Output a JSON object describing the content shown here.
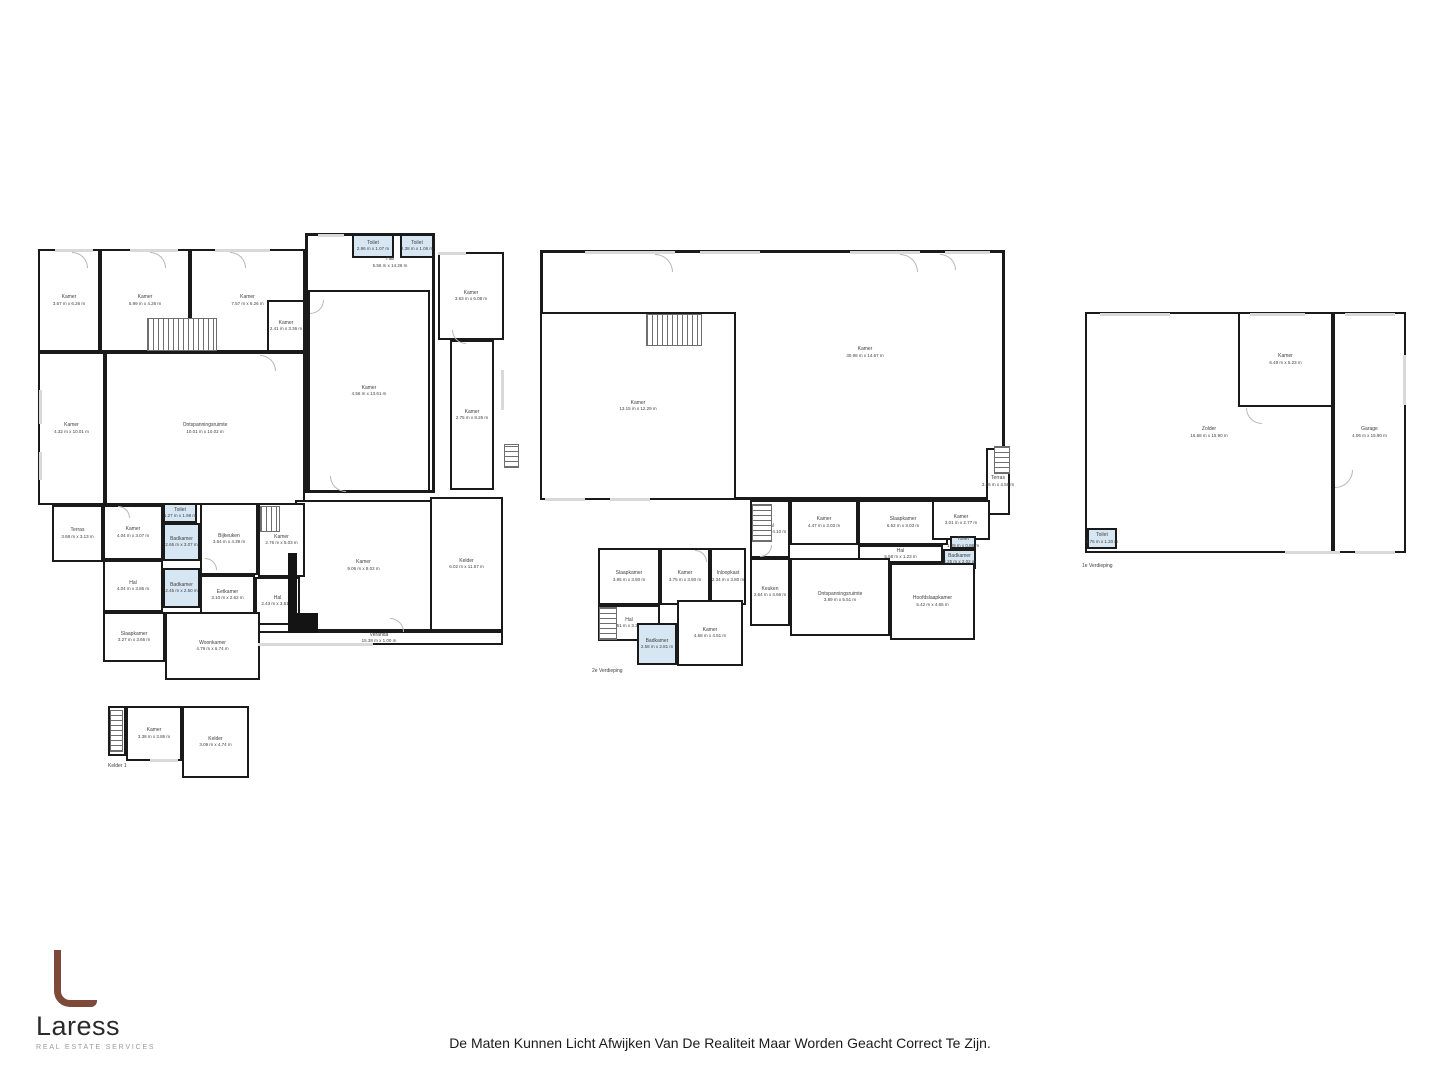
{
  "page": {
    "background": "#ffffff",
    "disclaimer": "De Maten Kunnen Licht Afwijken Van De Realiteit Maar Worden Geacht Correct Te Zijn."
  },
  "logo": {
    "name": "Laress",
    "subtitle": "REAL ESTATE SERVICES",
    "accent": "#7d4938"
  },
  "colors": {
    "wall": "#1a1a1a",
    "wet": "#d7e6f3",
    "window": "#d9d9d9",
    "label": "#3f3f3f",
    "door": "#b8b8b8",
    "shaft": "#141414"
  },
  "plans": [
    {
      "id": "begane-grond",
      "floor_label": null,
      "outlines": [
        {
          "x": 305,
          "y": 233,
          "w": 130,
          "h": 260
        }
      ],
      "texts": [
        {
          "name": "Hal",
          "dims": "5.56 m x 14.26 m",
          "x": 345,
          "y": 256,
          "w": 90
        }
      ],
      "rooms": [
        {
          "name": "Kamer",
          "dims": "3.67 m x 6.26 m",
          "x": 38,
          "y": 249,
          "w": 62,
          "h": 103
        },
        {
          "name": "Kamer",
          "dims": "5.99 m x 4.26 m",
          "x": 100,
          "y": 249,
          "w": 90,
          "h": 103
        },
        {
          "name": "Kamer",
          "dims": "7.57 m x 6.26 m",
          "x": 190,
          "y": 249,
          "w": 115,
          "h": 103
        },
        {
          "name": "Kamer",
          "dims": "2.41 m x 3.36 m",
          "x": 267,
          "y": 300,
          "w": 38,
          "h": 52
        },
        {
          "name": "Kamer",
          "dims": "4.32 m x 10.01 m",
          "x": 38,
          "y": 352,
          "w": 67,
          "h": 153
        },
        {
          "name": "Ontspanningsruimte",
          "dims": "10.01 m x 10.02 m",
          "x": 105,
          "y": 352,
          "w": 200,
          "h": 153
        },
        {
          "name": "Toilet",
          "dims": "2.96 m x 1.07 m",
          "x": 352,
          "y": 234,
          "w": 42,
          "h": 24,
          "wet": true
        },
        {
          "name": "Toilet",
          "dims": "2.38 m x 1.06 m",
          "x": 400,
          "y": 234,
          "w": 34,
          "h": 24,
          "wet": true
        },
        {
          "name": "Kamer",
          "dims": "4.56 m x 13.61 m",
          "x": 308,
          "y": 290,
          "w": 122,
          "h": 202
        },
        {
          "name": "Kamer",
          "dims": "3.63 m x 6.08 m",
          "x": 438,
          "y": 252,
          "w": 66,
          "h": 88
        },
        {
          "name": "Kamer",
          "dims": "2.75 m x 8.26 m",
          "x": 450,
          "y": 340,
          "w": 44,
          "h": 150
        },
        {
          "name": "Kelder",
          "dims": "6.02 m x 11.57 m",
          "x": 430,
          "y": 497,
          "w": 73,
          "h": 134
        },
        {
          "name": "Kamer",
          "dims": "9.06 m x 8.02 m",
          "x": 295,
          "y": 500,
          "w": 137,
          "h": 131
        },
        {
          "name": "Veranda",
          "dims": "15.38 m x 1.00 m",
          "x": 255,
          "y": 631,
          "w": 248,
          "h": 14
        },
        {
          "name": "Terras",
          "dims": "3.68 m x 3.13 m",
          "x": 52,
          "y": 505,
          "w": 51,
          "h": 57
        },
        {
          "name": "Kamer",
          "dims": "4.04 m x 3.07 m",
          "x": 103,
          "y": 505,
          "w": 60,
          "h": 55
        },
        {
          "name": "Toilet",
          "dims": "1.27 m x 1.98 m",
          "x": 163,
          "y": 503,
          "w": 34,
          "h": 20,
          "wet": true
        },
        {
          "name": "Badkamer",
          "dims": "2.65 m x 3.07 m",
          "x": 163,
          "y": 523,
          "w": 37,
          "h": 38,
          "wet": true
        },
        {
          "name": "Bijkeuken",
          "dims": "3.54 m x 4.39 m",
          "x": 200,
          "y": 503,
          "w": 58,
          "h": 72
        },
        {
          "name": "Kamer",
          "dims": "2.76 m x 5.03 m",
          "x": 258,
          "y": 503,
          "w": 47,
          "h": 74
        },
        {
          "name": "Hal",
          "dims": "4.04 m x 3.85 m",
          "x": 103,
          "y": 560,
          "w": 60,
          "h": 52
        },
        {
          "name": "Badkamer",
          "dims": "2.45 m x 2.50 m",
          "x": 163,
          "y": 568,
          "w": 37,
          "h": 40,
          "wet": true
        },
        {
          "name": "Eetkamer",
          "dims": "3.10 m x 2.62 m",
          "x": 200,
          "y": 575,
          "w": 55,
          "h": 40
        },
        {
          "name": "Hal",
          "dims": "2.43 m x 3.51 m",
          "x": 255,
          "y": 577,
          "w": 45,
          "h": 48
        },
        {
          "name": "Slaapkamer",
          "dims": "3.27 m x 3.66 m",
          "x": 103,
          "y": 612,
          "w": 62,
          "h": 50
        },
        {
          "name": "Woonkamer",
          "dims": "4.79 m x 6.74 m",
          "x": 165,
          "y": 612,
          "w": 95,
          "h": 68
        }
      ],
      "features": [
        {
          "type": "stairs",
          "x": 147,
          "y": 318,
          "w": 70,
          "h": 33,
          "angle": 90
        },
        {
          "type": "stairs",
          "x": 504,
          "y": 444,
          "w": 15,
          "h": 24,
          "angle": 0
        },
        {
          "type": "stairs",
          "x": 260,
          "y": 506,
          "w": 20,
          "h": 26,
          "angle": 90
        },
        {
          "type": "shaft",
          "x": 288,
          "y": 553,
          "w": 9,
          "h": 80
        },
        {
          "type": "shaft",
          "x": 288,
          "y": 613,
          "w": 30,
          "h": 20
        },
        {
          "type": "window",
          "x": 55,
          "y": 249,
          "w": 38,
          "h": 3
        },
        {
          "type": "window",
          "x": 130,
          "y": 249,
          "w": 48,
          "h": 3
        },
        {
          "type": "window",
          "x": 215,
          "y": 249,
          "w": 55,
          "h": 3
        },
        {
          "type": "window",
          "x": 318,
          "y": 234,
          "w": 26,
          "h": 3
        },
        {
          "type": "window",
          "x": 39,
          "y": 390,
          "w": 3,
          "h": 34
        },
        {
          "type": "window",
          "x": 39,
          "y": 452,
          "w": 3,
          "h": 28
        },
        {
          "type": "window",
          "x": 258,
          "y": 643,
          "w": 115,
          "h": 3
        },
        {
          "type": "window",
          "x": 438,
          "y": 252,
          "w": 28,
          "h": 3
        },
        {
          "type": "window",
          "x": 501,
          "y": 370,
          "w": 3,
          "h": 40
        },
        {
          "type": "door",
          "x": 72,
          "y": 252,
          "s": 16,
          "rot": 0
        },
        {
          "type": "door",
          "x": 150,
          "y": 252,
          "s": 16,
          "rot": 0
        },
        {
          "type": "door",
          "x": 230,
          "y": 252,
          "s": 16,
          "rot": 0
        },
        {
          "type": "door",
          "x": 310,
          "y": 300,
          "s": 14,
          "rot": 90
        },
        {
          "type": "door",
          "x": 330,
          "y": 476,
          "s": 16,
          "rot": 180
        },
        {
          "type": "door",
          "x": 452,
          "y": 330,
          "s": 14,
          "rot": 180
        },
        {
          "type": "door",
          "x": 205,
          "y": 558,
          "s": 12,
          "rot": 0
        },
        {
          "type": "door",
          "x": 118,
          "y": 506,
          "s": 12,
          "rot": 0
        },
        {
          "type": "door",
          "x": 390,
          "y": 618,
          "s": 14,
          "rot": 0
        },
        {
          "type": "door",
          "x": 260,
          "y": 355,
          "s": 16,
          "rot": 0
        }
      ]
    },
    {
      "id": "kelder-1",
      "floor_label": {
        "text": "Kelder 1",
        "x": 108,
        "y": 763
      },
      "outlines": [],
      "texts": [],
      "rooms": [
        {
          "name": "Hal",
          "dims": "2.03 m x 1.04 m",
          "x": 108,
          "y": 706,
          "w": 18,
          "h": 50,
          "vertical": true
        },
        {
          "name": "Kamer",
          "dims": "3.38 m x 3.86 m",
          "x": 126,
          "y": 706,
          "w": 56,
          "h": 55
        },
        {
          "name": "Kelder",
          "dims": "3.09 m x 4.74 m",
          "x": 182,
          "y": 706,
          "w": 67,
          "h": 72
        }
      ],
      "features": [
        {
          "type": "stairs",
          "x": 110,
          "y": 710,
          "w": 13,
          "h": 42,
          "angle": 0
        },
        {
          "type": "window",
          "x": 150,
          "y": 759,
          "w": 28,
          "h": 3
        }
      ]
    },
    {
      "id": "2e-verdieping",
      "floor_label": {
        "text": "2e Verdieping",
        "x": 592,
        "y": 668
      },
      "outlines": [
        {
          "x": 540,
          "y": 250,
          "w": 465,
          "h": 250
        }
      ],
      "texts": [
        {
          "name": "Kamer",
          "dims": "30.98 m x 14.67 m",
          "x": 810,
          "y": 346,
          "w": 110
        }
      ],
      "rooms": [
        {
          "name": "Kamer",
          "dims": "13.15 m x 12.29 m",
          "x": 540,
          "y": 312,
          "w": 196,
          "h": 188
        },
        {
          "name": "Terras",
          "dims": "3.46 m x 4.56 m",
          "x": 986,
          "y": 448,
          "w": 24,
          "h": 67
        },
        {
          "name": "Hal",
          "dims": "2.64 m x 4.10 m",
          "x": 750,
          "y": 500,
          "w": 40,
          "h": 58
        },
        {
          "name": "Kamer",
          "dims": "4.47 m x 3.03 m",
          "x": 790,
          "y": 500,
          "w": 68,
          "h": 45
        },
        {
          "name": "Slaapkamer",
          "dims": "6.52 m x 3.03 m",
          "x": 858,
          "y": 500,
          "w": 90,
          "h": 45
        },
        {
          "name": "Kamer",
          "dims": "3.01 m x 2.77 m",
          "x": 932,
          "y": 500,
          "w": 58,
          "h": 40
        },
        {
          "name": "Toilet",
          "dims": "1.29 m x 0.86 m",
          "x": 950,
          "y": 536,
          "w": 26,
          "h": 13,
          "wet": true
        },
        {
          "name": "Badkamer",
          "dims": "2.25 m x 2.02 m",
          "x": 943,
          "y": 549,
          "w": 33,
          "h": 20,
          "wet": true
        },
        {
          "name": "Hal",
          "dims": "5.58 m x 1.23 m",
          "x": 858,
          "y": 545,
          "w": 85,
          "h": 18
        },
        {
          "name": "Keuken",
          "dims": "2.64 m x 4.66 m",
          "x": 750,
          "y": 558,
          "w": 40,
          "h": 68
        },
        {
          "name": "Ontspanningsruimte",
          "dims": "3.89 m x 5.51 m",
          "x": 790,
          "y": 558,
          "w": 100,
          "h": 78
        },
        {
          "name": "Hoofdslaapkamer",
          "dims": "5.42 m x 4.65 m",
          "x": 890,
          "y": 563,
          "w": 85,
          "h": 77
        },
        {
          "name": "Slaapkamer",
          "dims": "3.95 m x 3.80 m",
          "x": 598,
          "y": 548,
          "w": 62,
          "h": 57
        },
        {
          "name": "Kamer",
          "dims": "3.75 m x 3.80 m",
          "x": 660,
          "y": 548,
          "w": 50,
          "h": 57
        },
        {
          "name": "Inloopkast",
          "dims": "2.34 m x 3.80 m",
          "x": 710,
          "y": 548,
          "w": 36,
          "h": 57
        },
        {
          "name": "Hal",
          "dims": "5.51 m x 3.36 m",
          "x": 598,
          "y": 605,
          "w": 62,
          "h": 36
        },
        {
          "name": "Badkamer",
          "dims": "2.58 m x 2.81 m",
          "x": 637,
          "y": 623,
          "w": 40,
          "h": 42,
          "wet": true
        },
        {
          "name": "Kamer",
          "dims": "4.58 m x 4.51 m",
          "x": 677,
          "y": 600,
          "w": 66,
          "h": 66
        }
      ],
      "features": [
        {
          "type": "stairs",
          "x": 646,
          "y": 314,
          "w": 56,
          "h": 32,
          "angle": 90
        },
        {
          "type": "stairs",
          "x": 752,
          "y": 504,
          "w": 20,
          "h": 38,
          "angle": 0
        },
        {
          "type": "stairs",
          "x": 599,
          "y": 607,
          "w": 18,
          "h": 33,
          "angle": 0
        },
        {
          "type": "stairs",
          "x": 994,
          "y": 446,
          "w": 16,
          "h": 28,
          "angle": 0
        },
        {
          "type": "window",
          "x": 585,
          "y": 251,
          "w": 90,
          "h": 3
        },
        {
          "type": "window",
          "x": 700,
          "y": 251,
          "w": 60,
          "h": 3
        },
        {
          "type": "window",
          "x": 850,
          "y": 251,
          "w": 70,
          "h": 3
        },
        {
          "type": "window",
          "x": 945,
          "y": 251,
          "w": 45,
          "h": 3
        },
        {
          "type": "window",
          "x": 545,
          "y": 498,
          "w": 40,
          "h": 3
        },
        {
          "type": "window",
          "x": 610,
          "y": 498,
          "w": 40,
          "h": 3
        },
        {
          "type": "door",
          "x": 655,
          "y": 254,
          "s": 18,
          "rot": 0
        },
        {
          "type": "door",
          "x": 900,
          "y": 254,
          "s": 18,
          "rot": 0
        },
        {
          "type": "door",
          "x": 940,
          "y": 254,
          "s": 16,
          "rot": 0
        },
        {
          "type": "door",
          "x": 760,
          "y": 545,
          "s": 12,
          "rot": 90
        },
        {
          "type": "door",
          "x": 695,
          "y": 550,
          "s": 12,
          "rot": 0
        }
      ]
    },
    {
      "id": "1e-verdieping",
      "floor_label": {
        "text": "1e Verdieping",
        "x": 1082,
        "y": 563
      },
      "outlines": [],
      "texts": [],
      "rooms": [
        {
          "name": "Zolder",
          "dims": "16.68 m x 15.90 m",
          "x": 1085,
          "y": 312,
          "w": 248,
          "h": 241
        },
        {
          "name": "Kamer",
          "dims": "6.49 m x 5.23 m",
          "x": 1238,
          "y": 312,
          "w": 95,
          "h": 95
        },
        {
          "name": "Garage",
          "dims": "4.06 m x 15.90 m",
          "x": 1333,
          "y": 312,
          "w": 73,
          "h": 241
        },
        {
          "name": "Toilet",
          "dims": "1.76 m x 1.20 m",
          "x": 1087,
          "y": 528,
          "w": 30,
          "h": 21,
          "wet": true
        }
      ],
      "features": [
        {
          "type": "window",
          "x": 1100,
          "y": 313,
          "w": 70,
          "h": 3
        },
        {
          "type": "window",
          "x": 1250,
          "y": 313,
          "w": 55,
          "h": 3
        },
        {
          "type": "window",
          "x": 1345,
          "y": 313,
          "w": 50,
          "h": 3
        },
        {
          "type": "window",
          "x": 1285,
          "y": 551,
          "w": 55,
          "h": 3
        },
        {
          "type": "window",
          "x": 1355,
          "y": 551,
          "w": 40,
          "h": 3
        },
        {
          "type": "window",
          "x": 1403,
          "y": 355,
          "w": 3,
          "h": 50
        },
        {
          "type": "door",
          "x": 1246,
          "y": 408,
          "s": 16,
          "rot": 180
        },
        {
          "type": "door",
          "x": 1335,
          "y": 470,
          "s": 18,
          "rot": 90
        }
      ]
    }
  ]
}
